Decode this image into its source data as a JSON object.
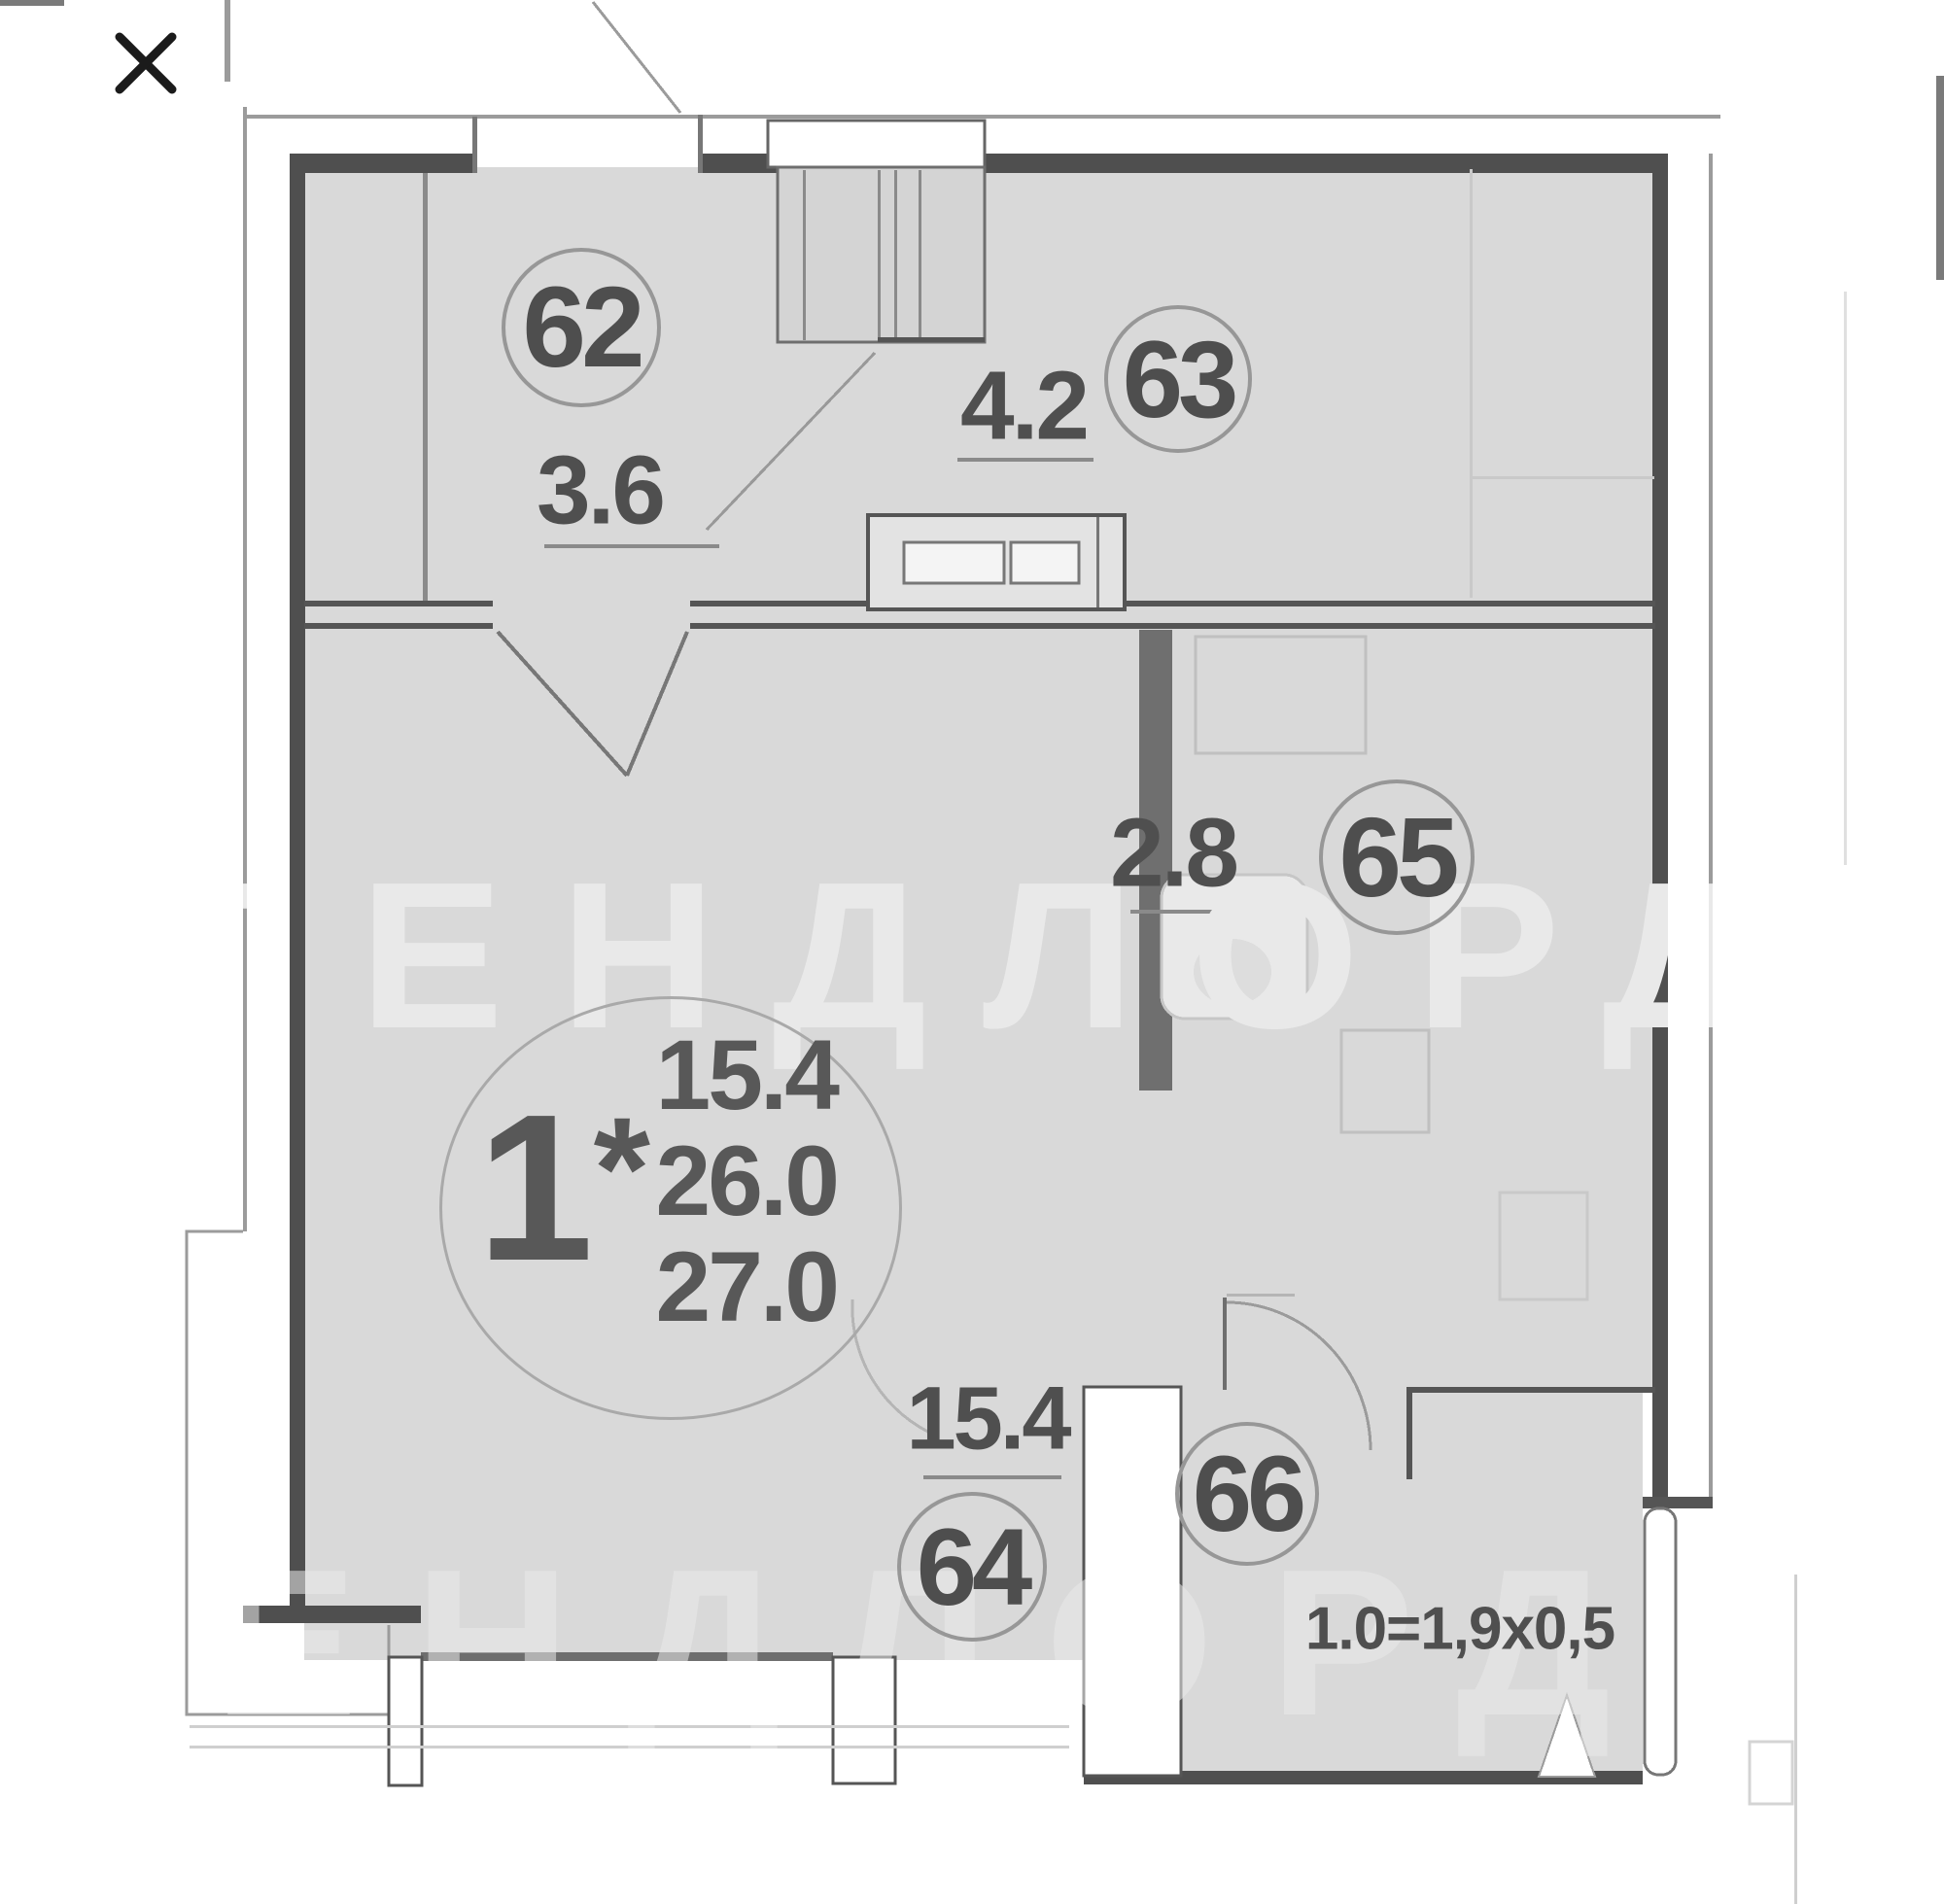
{
  "plan": {
    "watermark": "ЛЕНДЛОРД",
    "watermark_secondary": "ЛЕНДЛОРД",
    "apartment": {
      "type_number": "1",
      "type_star": "*",
      "living_area": "15.4",
      "total_area": "26.0",
      "overall_area": "27.0"
    },
    "rooms": [
      {
        "number": "62",
        "area": "3.6"
      },
      {
        "number": "63",
        "area": "4.2"
      },
      {
        "number": "64",
        "area": "15.4"
      },
      {
        "number": "65",
        "area": "2.8"
      },
      {
        "number": "66"
      }
    ],
    "dimension_note": "1.0=1,9x0,5"
  }
}
